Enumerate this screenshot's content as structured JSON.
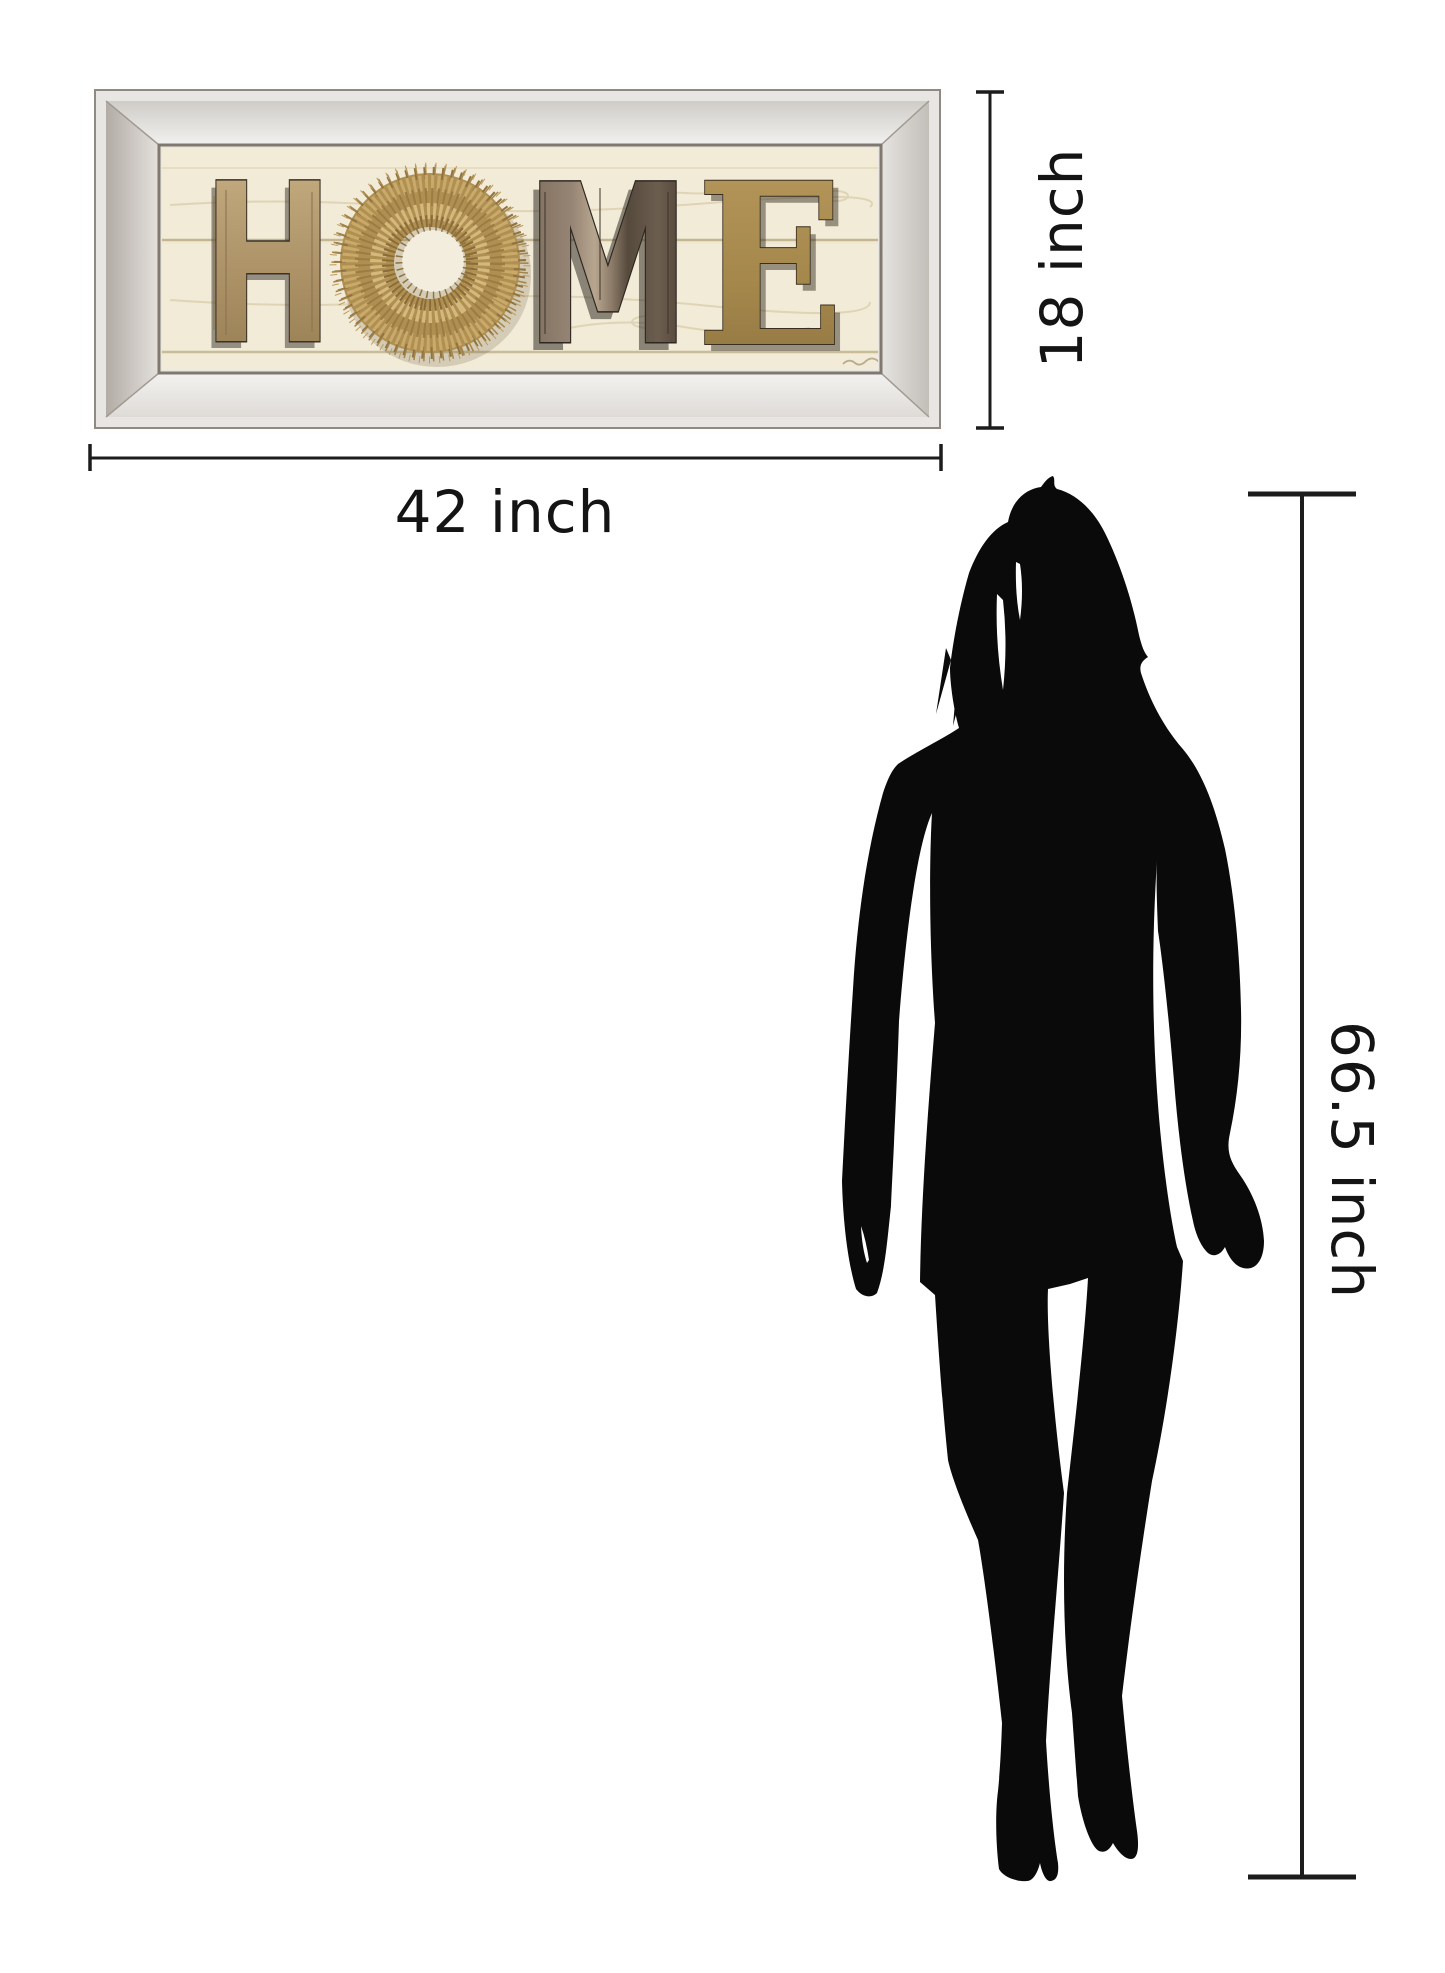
{
  "diagram": {
    "artwork": {
      "word": "HOME",
      "letters": {
        "h": "H",
        "m": "M",
        "e": "E",
        "o": "wreath-icon"
      },
      "frame_style": "beveled-mirror-frame"
    },
    "measurements": {
      "artwork_width": "42 inch",
      "artwork_height": "18 inch",
      "person_height": "66.5 inch"
    },
    "colors": {
      "background": "#ffffff",
      "dimension_lines": "#1c1c1c",
      "silhouette": "#0a0a0a",
      "frame_silver": "#e8e6e3",
      "art_background": "#f2ebd7",
      "wood_h": "#b49b72",
      "wreath_gold": "#b09050",
      "wood_m_dark": "#6f6152",
      "wood_e_gold": "#a5874c"
    }
  }
}
